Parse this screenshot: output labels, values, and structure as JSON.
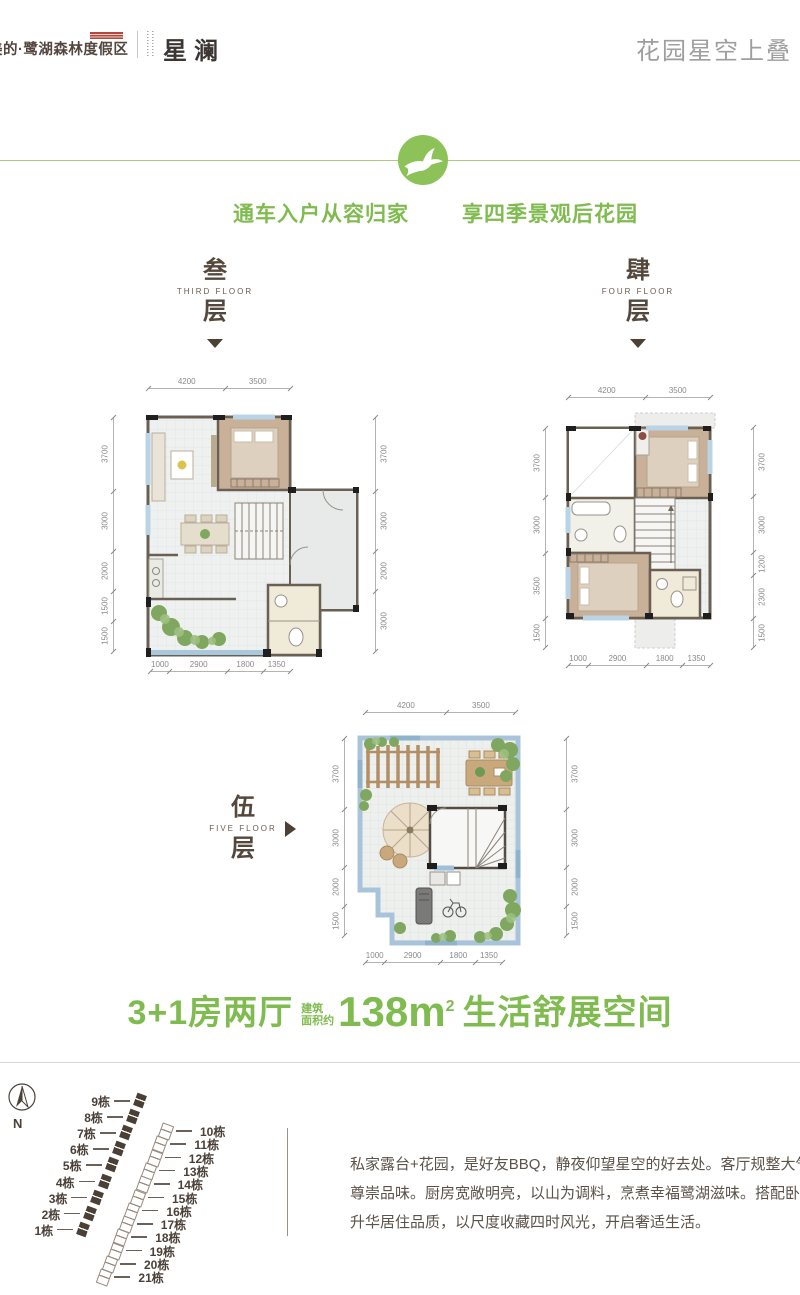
{
  "header": {
    "brand": "美的·鹭湖森林度假区",
    "sub_brand": "星澜",
    "tagline": "花园星空上叠"
  },
  "slogans": {
    "left": "通车入户从容归家",
    "right": "享四季景观后花园"
  },
  "floors": [
    {
      "cn": "叁",
      "en": "THIRD FLOOR",
      "cn2": "层"
    },
    {
      "cn": "肆",
      "en": "FOUR FLOOR",
      "cn2": "层"
    },
    {
      "cn": "伍",
      "en": "FIVE FLOOR",
      "cn2": "层"
    }
  ],
  "floor_plans": [
    {
      "id": "plan3",
      "name": "third-floor-plan",
      "dims": {
        "top": [
          "4200",
          "3500"
        ],
        "left": [
          "3700",
          "3000",
          "2000",
          "1500",
          "1500"
        ],
        "right": [
          "3700",
          "3000",
          "2000",
          "3000"
        ],
        "bottom": [
          "1000",
          "2900",
          "1800",
          "1350"
        ]
      }
    },
    {
      "id": "plan4",
      "name": "fourth-floor-plan",
      "dims": {
        "top": [
          "4200",
          "3500"
        ],
        "left": [
          "3700",
          "3000",
          "3500",
          "1500"
        ],
        "right": [
          "3700",
          "3000",
          "1200",
          "2300",
          "1500"
        ],
        "bottom": [
          "1000",
          "2900",
          "1800",
          "1350"
        ]
      }
    },
    {
      "id": "plan5",
      "name": "fifth-floor-plan",
      "dims": {
        "top": [
          "4200",
          "3500"
        ],
        "left": [
          "3700",
          "3000",
          "2000",
          "1500"
        ],
        "right": [
          "3700",
          "3000",
          "2000",
          "1500"
        ],
        "bottom": [
          "1000",
          "2900",
          "1800",
          "1350"
        ]
      }
    }
  ],
  "headline": {
    "part1": "3+1房两厅",
    "small1": "建筑",
    "small2": "面积约",
    "area": "138m",
    "area_sup": "2",
    "part2": "生活舒展空间"
  },
  "site_plan": {
    "north_label": "N",
    "left_buildings": [
      "9栋",
      "8栋",
      "7栋",
      "6栋",
      "5栋",
      "4栋",
      "3栋",
      "2栋",
      "1栋"
    ],
    "right_buildings": [
      "10栋",
      "11栋",
      "12栋",
      "13栋",
      "14栋",
      "15栋",
      "16栋",
      "17栋",
      "18栋",
      "19栋",
      "20栋",
      "21栋"
    ]
  },
  "description": {
    "lines": [
      "私家露台+花园，是好友BBQ，静夜仰望星空的好去处。客厅规整大气，尽显主人",
      "尊崇品味。厨房宽敞明亮，以山为调料，烹煮幸福鹭湖滋味。搭配卧室飘窗，以",
      "升华居住品质，以尺度收藏四时风光，开启奢适生活。"
    ]
  },
  "colors": {
    "green": "#7fbb4f",
    "brown": "#54483c",
    "gray": "#9e9e9e",
    "badge_red": "#b5463c",
    "terrace_blue": "#a9c4da"
  }
}
